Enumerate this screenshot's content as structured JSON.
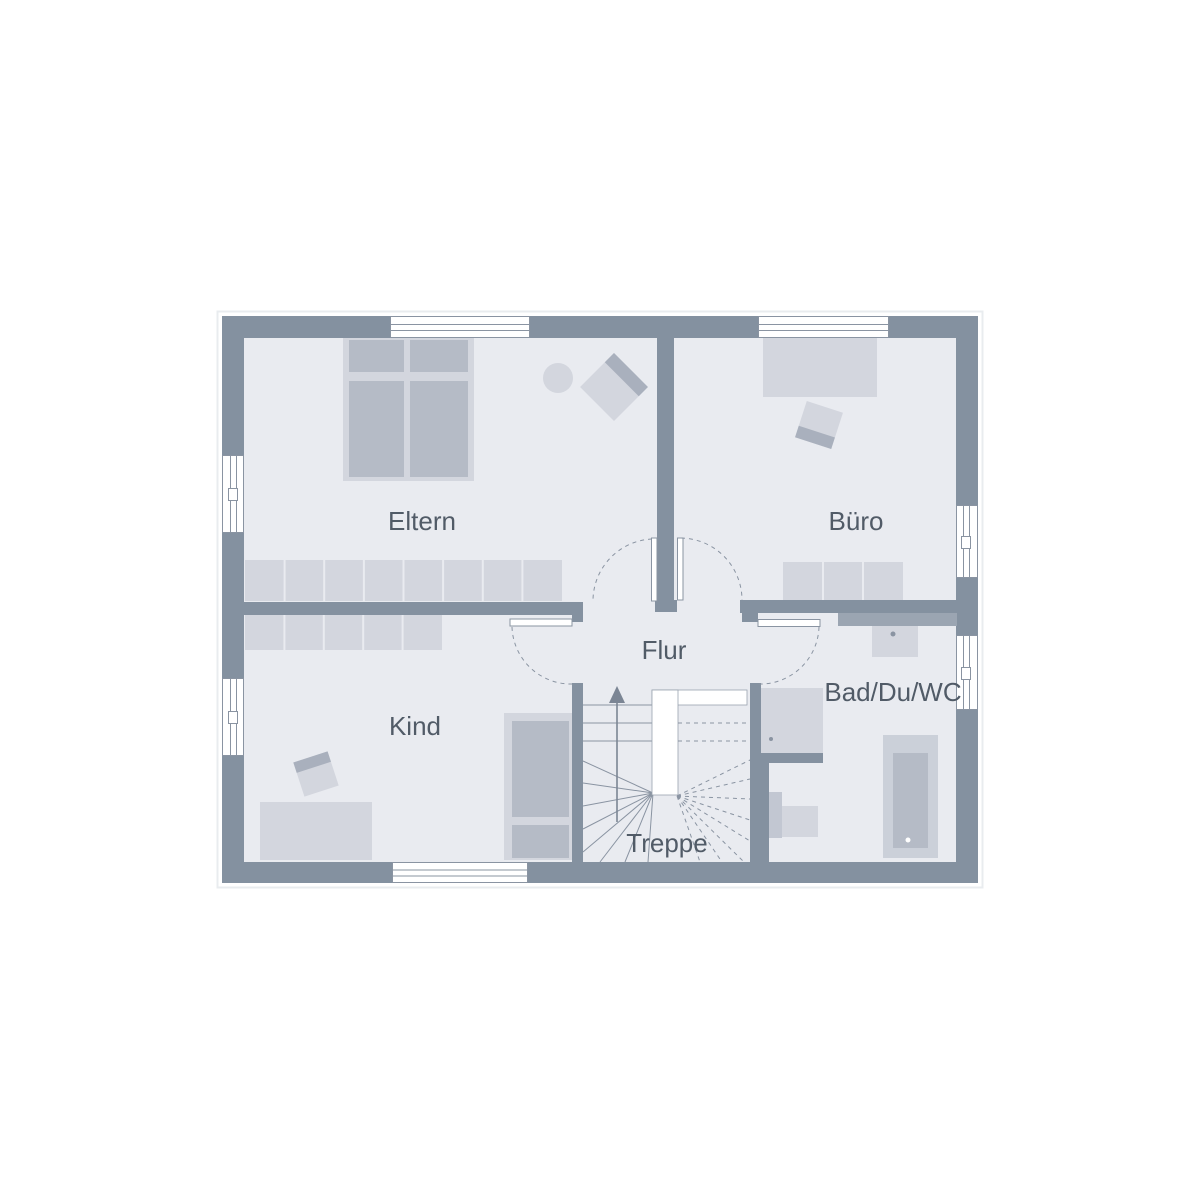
{
  "rooms": [
    {
      "label": "Eltern"
    },
    {
      "label": "Büro"
    },
    {
      "label": "Flur"
    },
    {
      "label": "Kind"
    },
    {
      "label": "Bad/Du/WC"
    },
    {
      "label": "Treppe"
    }
  ],
  "colors": {
    "wall": "#8491a0",
    "wall-light": "#9ba5b2",
    "floor": "#e9ebf0",
    "furn-light": "#d3d6de",
    "furn-mid": "#b5bbc6",
    "chair-band": "#a9b0bd",
    "tub-outer": "#cbd0d9",
    "tank": "#c2c7d2",
    "line": "#8a94a2",
    "arrow": "#7b8594",
    "text": "#515b67",
    "faint": "#e9ecef"
  }
}
